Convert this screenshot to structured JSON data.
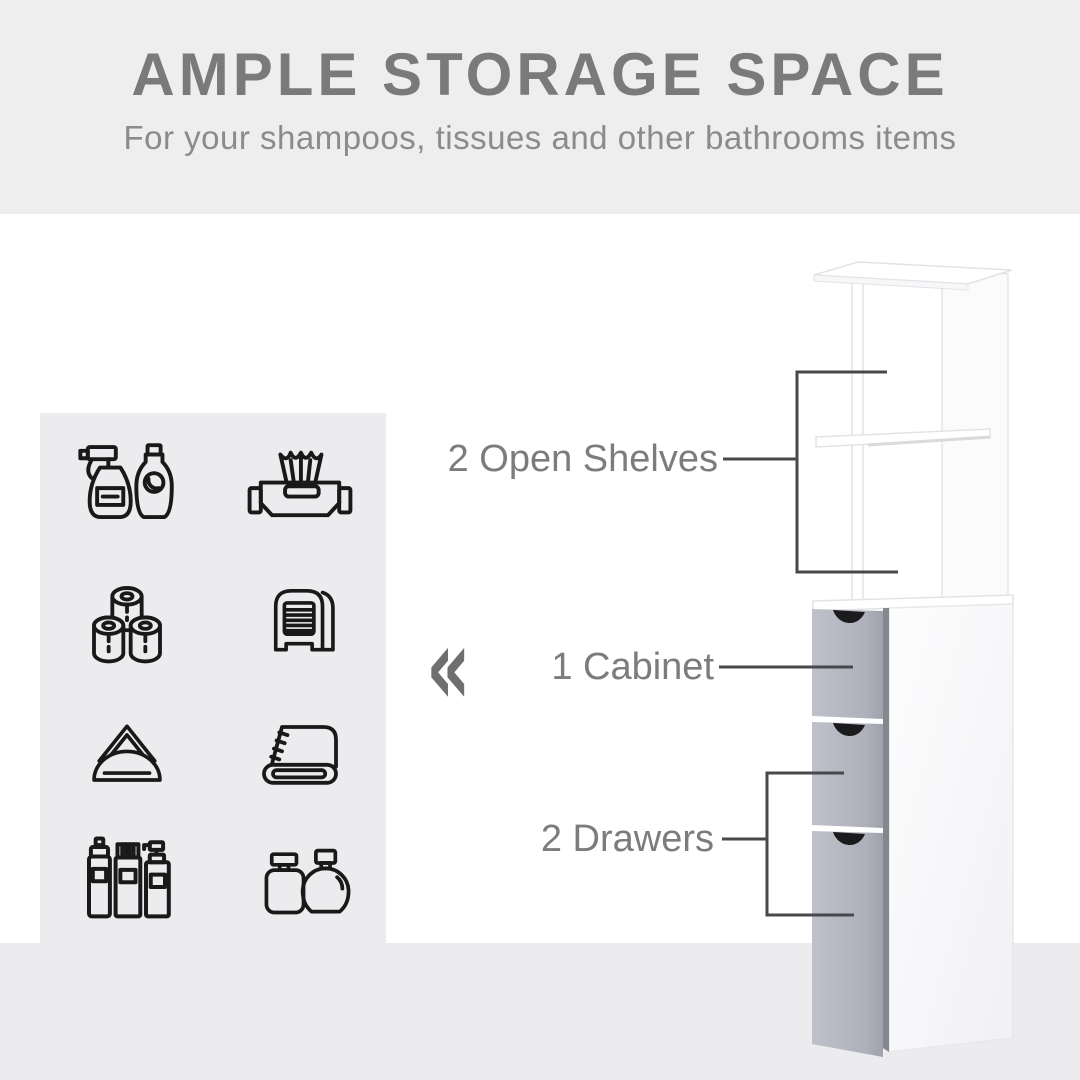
{
  "header": {
    "title": "AMPLE STORAGE SPACE",
    "subtitle": "For your shampoos, tissues and other bathrooms items",
    "background": "#eeeeef",
    "title_color": "#7a7a7a",
    "subtitle_color": "#8b8b8b"
  },
  "icon_panel": {
    "background": "#ececee",
    "icons": [
      {
        "name": "cleaning-spray-bottle-icon",
        "label": "Spray cleaner and detergent bottle"
      },
      {
        "name": "wet-wipes-icon",
        "label": "Wet wipes pack"
      },
      {
        "name": "toilet-paper-rolls-icon",
        "label": "Toilet paper rolls"
      },
      {
        "name": "tissue-dispenser-icon",
        "label": "Tissue dispenser"
      },
      {
        "name": "napkin-holder-icon",
        "label": "Napkin holder"
      },
      {
        "name": "folded-towel-icon",
        "label": "Folded towel"
      },
      {
        "name": "toiletry-bottles-icon",
        "label": "Toiletry spray cans and bottles"
      },
      {
        "name": "perfume-bottles-icon",
        "label": "Perfume bottles"
      }
    ]
  },
  "divider": {
    "chevron_glyph": "«"
  },
  "callouts": [
    {
      "id": "open-shelves",
      "label": "2 Open Shelves"
    },
    {
      "id": "cabinet",
      "label": "1 Cabinet"
    },
    {
      "id": "drawers",
      "label": "2 Drawers"
    }
  ],
  "product": {
    "name": "Tall bathroom storage cabinet",
    "colors": {
      "body_white": "#ffffff",
      "drawer_front_gray": "#b3b5c0",
      "drawer_edge_gray": "#85878f",
      "handle_notch": "#1b1b1e",
      "floor": "#ececee",
      "callout_line": "#48484a",
      "label_text": "#7c7c7c"
    }
  }
}
